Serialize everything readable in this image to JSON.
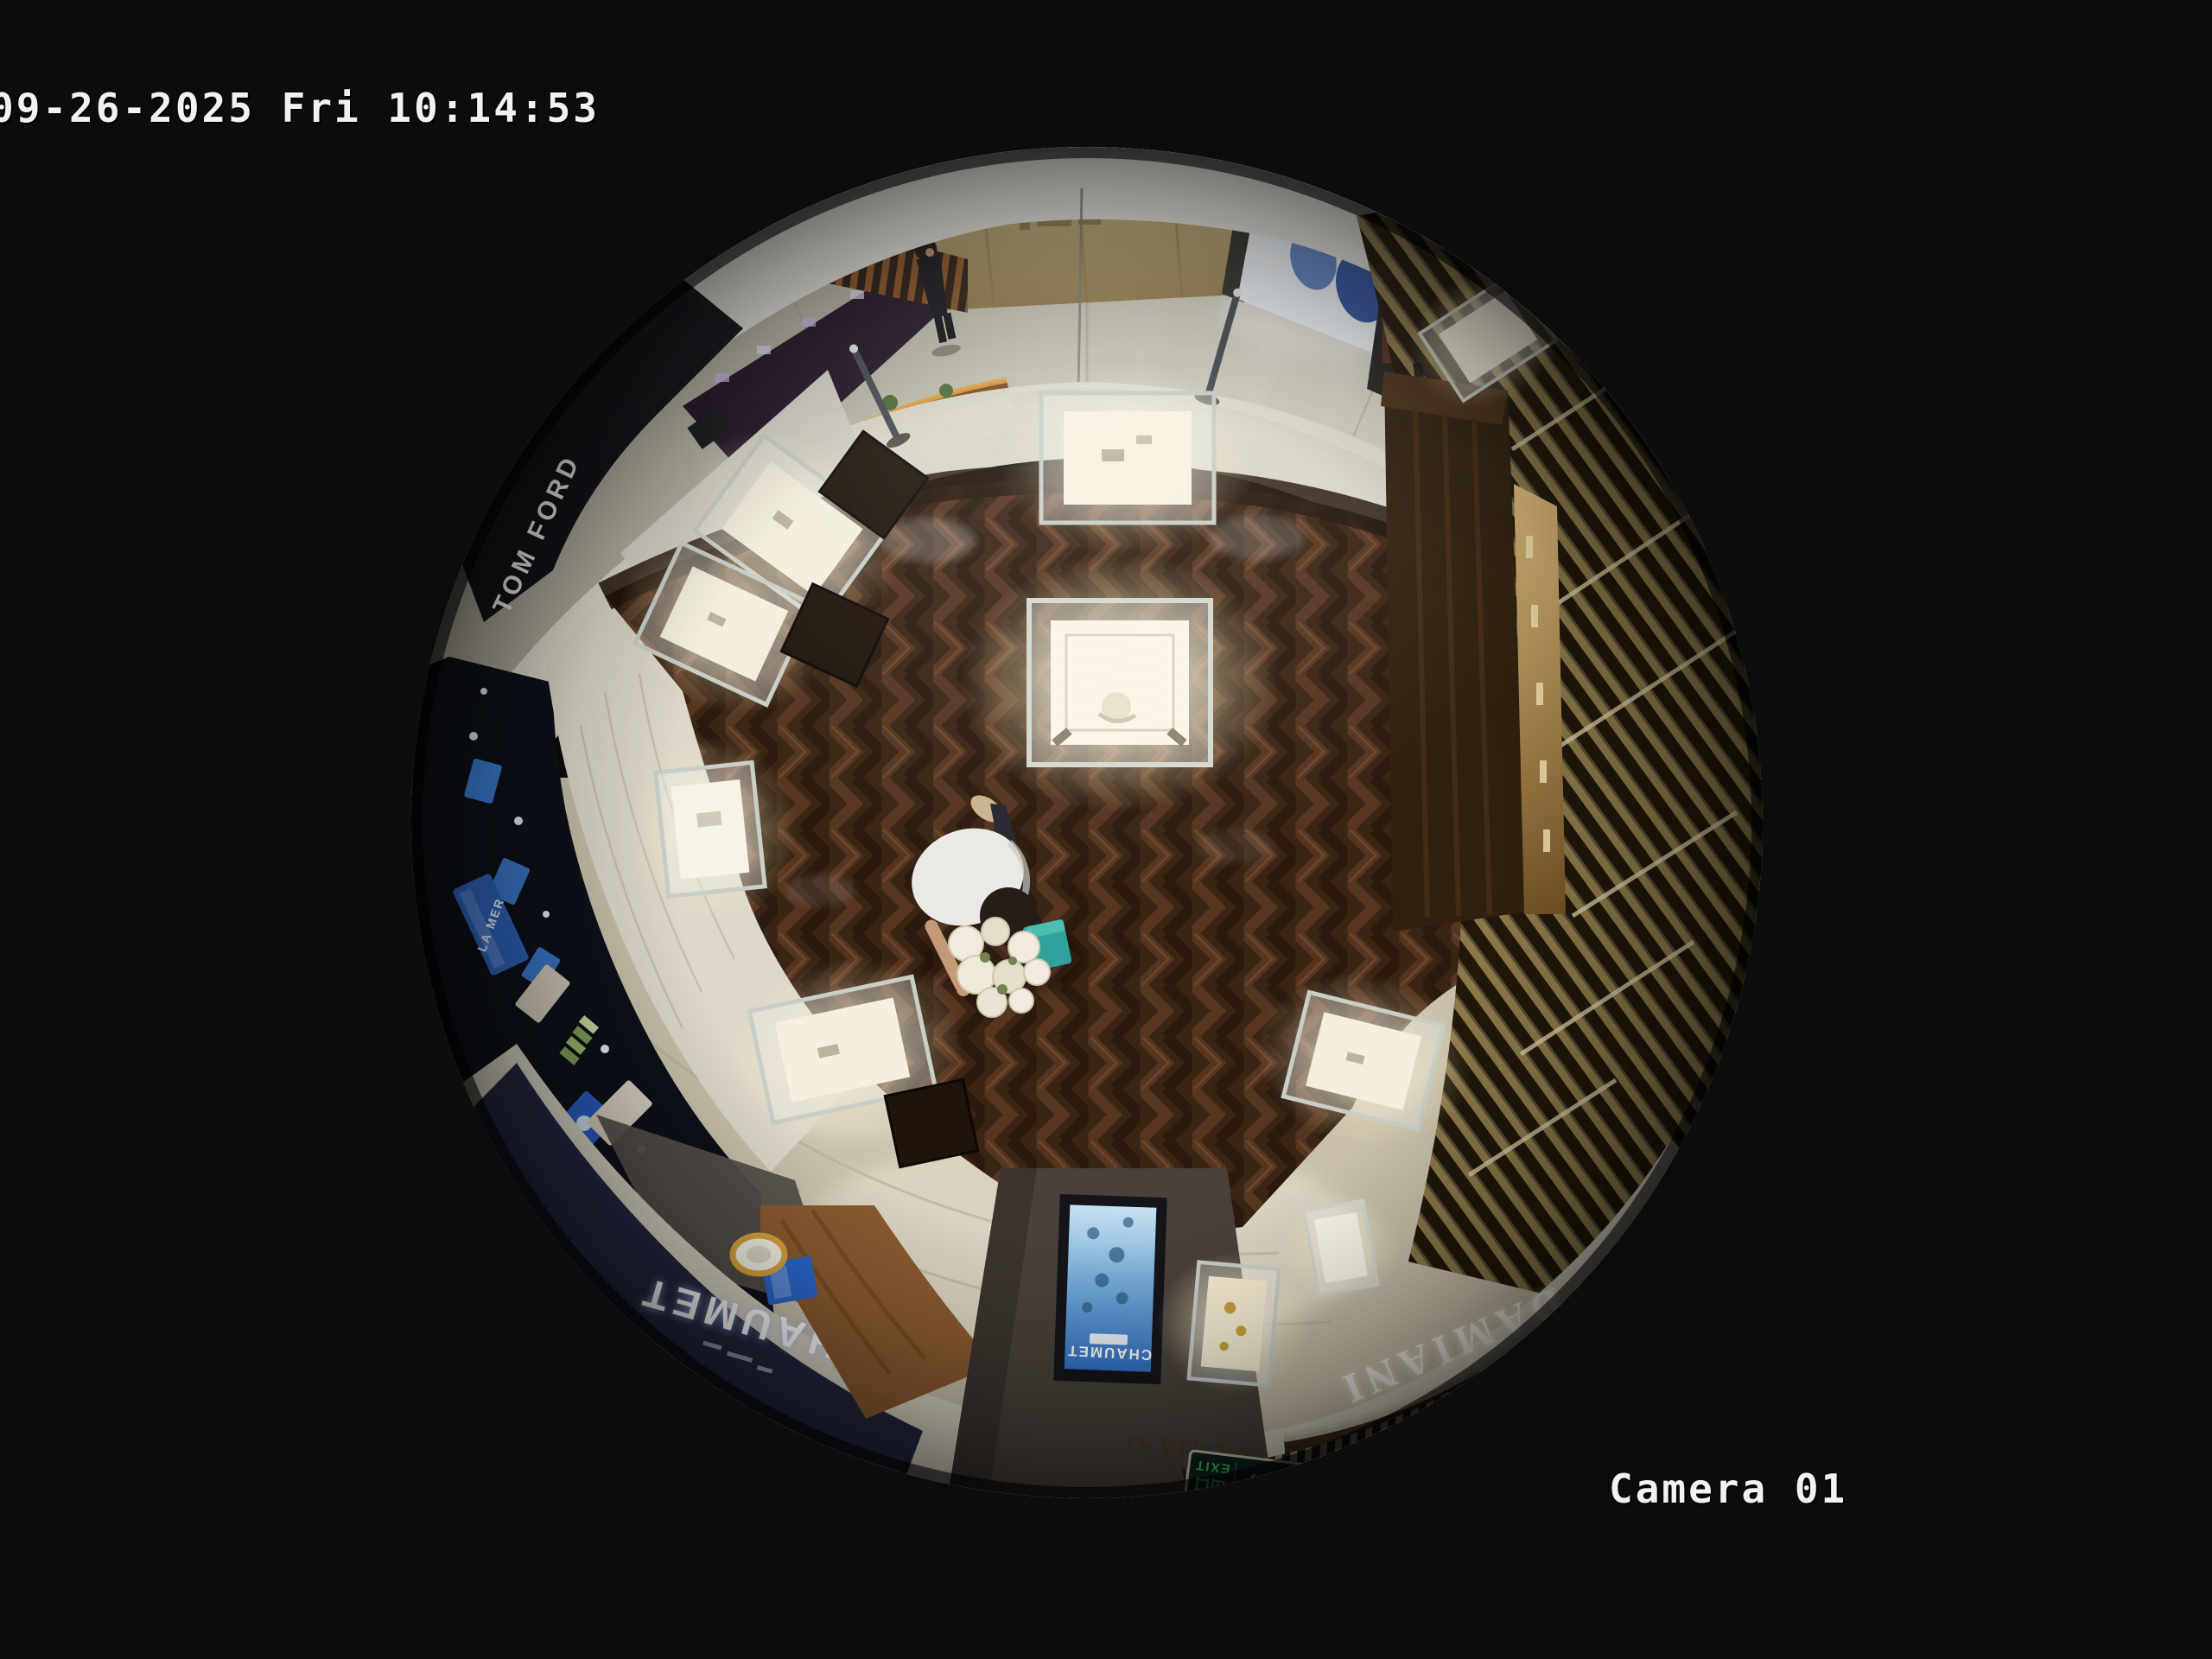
{
  "osd": {
    "timestamp": "09-26-2025 Fri 10:14:53",
    "camera_label": "Camera 01"
  },
  "scene": {
    "signs": {
      "tom_ford": "TOM FORD",
      "la_mer": "LA MER",
      "chaumet_fascia": "CHAUMET",
      "chaumet_screen": "CHAUMET",
      "damiani_fascia": "DAMIANI",
      "damiani_small": "DAMIANI",
      "exit_cn": "出口",
      "exit_en": "EXIT",
      "exit_arrow": "←"
    },
    "colors": {
      "background": "#0c0c0c",
      "wood_floor": "#3a2414",
      "marble_corridor": "#c6c3b4",
      "chaumet_fascia_bg": "#232840",
      "damiani_fascia_bg": "#3a2b1c",
      "screen_blue": "#2f6fc2",
      "exit_green": "#35d06a",
      "gift_box_teal": "#2fa39b",
      "osd_text": "#f2f2f2"
    }
  }
}
